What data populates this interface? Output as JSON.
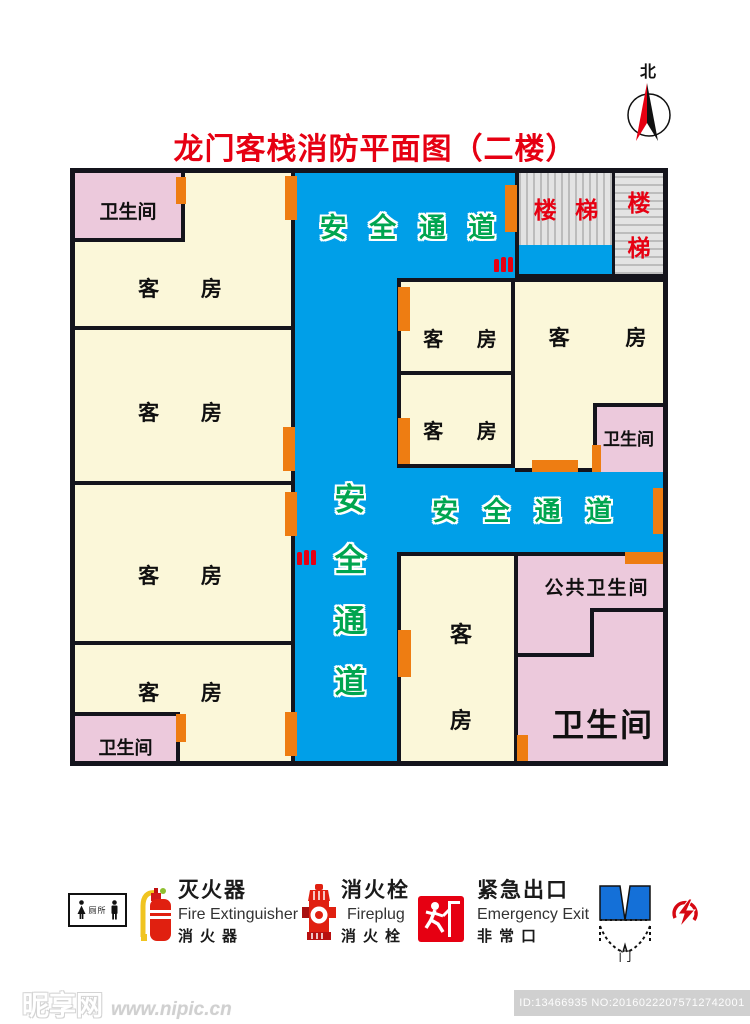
{
  "title": "龙门客栈消防平面图（二楼）",
  "compass": {
    "north_label": "北"
  },
  "corridors": {
    "top_label": "安 全 通 道",
    "middle_label": "安 全 通 道",
    "vertical_label": [
      "安",
      "全",
      "通",
      "道"
    ]
  },
  "rooms": {
    "bath_top_left": "卫生间",
    "guest_left_1": "客 房",
    "guest_left_2": "客 房",
    "guest_left_3": "客 房",
    "guest_left_4": "客 房",
    "bath_bottom_left": "卫生间",
    "stairs_left": "楼 梯",
    "stairs_right_top": "楼",
    "stairs_right_bottom": "梯",
    "guest_mid_top": "客 房",
    "guest_mid_bottom": "客 房",
    "guest_right": "客 房",
    "bath_right": "卫生间",
    "guest_bottom_char1": "客",
    "guest_bottom_char2": "房",
    "public_bath": "公共卫生间",
    "bath_large": "卫生间"
  },
  "legend": {
    "toilet_label": "厕所",
    "extinguisher": {
      "zh": "灭火器",
      "en": "Fire Extinguisher",
      "alt": "消火器"
    },
    "fireplug": {
      "zh": "消火栓",
      "en": "Fireplug",
      "alt": "消火栓"
    },
    "exit": {
      "zh": "紧急出口",
      "en": "Emergency Exit",
      "alt": "非常口"
    },
    "door_label": "门"
  },
  "watermark": {
    "site": "昵享网",
    "url": "www.nipic.cn",
    "id_text": "ID:13466935 NO:20160222075712742001"
  },
  "colors": {
    "corridor_blue": "#009FE8",
    "room_cream": "#FBF7D9",
    "bath_pink": "#ECC9DC",
    "door_orange": "#EE7D12",
    "accent_red": "#E60012",
    "corridor_green": "#00A550"
  }
}
